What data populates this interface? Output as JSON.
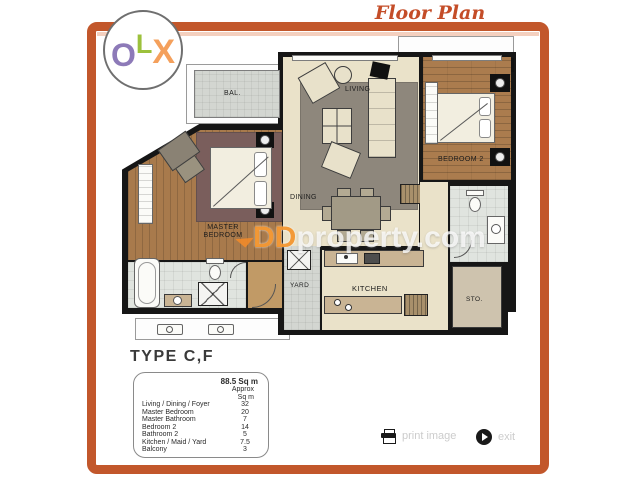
{
  "logo": {
    "letters": [
      {
        "char": "O",
        "color": "#8d7ab8"
      },
      {
        "char": "L",
        "color": "#9cc13c"
      },
      {
        "char": "X",
        "color": "#f4a05c"
      }
    ]
  },
  "header": {
    "title": "Floor Plan"
  },
  "plan": {
    "rooms": {
      "balcony": "BAL.",
      "living": "LIVING",
      "bedroom2": "BEDROOM 2",
      "dining": "DINING",
      "master": "MASTER BEDROOM",
      "yard": "YARD",
      "kitchen": "KITCHEN",
      "storage": "STO."
    },
    "watermark": {
      "dd": "DD",
      "rest": "property.com"
    }
  },
  "info": {
    "type_label": "TYPE C,F",
    "table": {
      "total": "88.5 Sq m",
      "approx1": "Approx",
      "approx2": "Sq m",
      "rows": [
        {
          "label": "Living / Dining / Foyer",
          "value": "32"
        },
        {
          "label": "Master Bedroom",
          "value": "20"
        },
        {
          "label": "Master Bathroom",
          "value": "7"
        },
        {
          "label": "Bedroom 2",
          "value": "14"
        },
        {
          "label": "Bathroom 2",
          "value": "5"
        },
        {
          "label": "Kitchen / Maid / Yard",
          "value": "7.5"
        },
        {
          "label": "Balcony",
          "value": "3"
        }
      ]
    }
  },
  "footer": {
    "print_label": "print image",
    "exit_label": "exit"
  },
  "colors": {
    "frame": "#c2572b",
    "title": "#c44d28",
    "watermark_orange": "#ef8a2a",
    "wall": "#161616",
    "wood": "#ab7c4e",
    "beige_floor": "#eae2c9"
  }
}
